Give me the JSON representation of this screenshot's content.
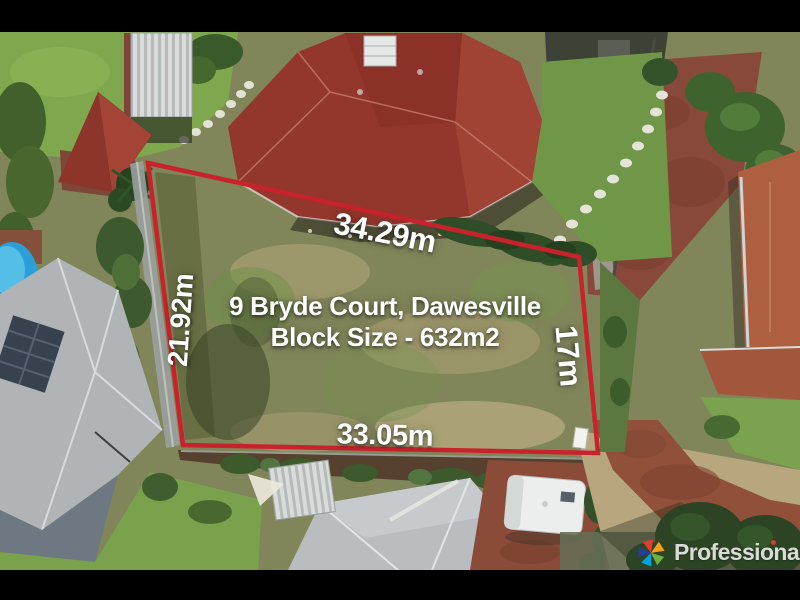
{
  "overlay": {
    "address_line1": "9 Bryde Court, Dawesville",
    "address_line2": "Block Size - 632m2",
    "dimensions": {
      "top": "34.29m",
      "left": "21.92m",
      "right": "17m",
      "bottom": "33.05m"
    }
  },
  "branding": {
    "agency_name": "Professionals",
    "logo_icon": "star-icon"
  },
  "colors": {
    "boundary_line": "#c8232c",
    "overlay_text": "#ffffff",
    "letterbox_bars": "#000000",
    "logo_text": "#e7e7e4",
    "logo_i_dot": "#e03c31",
    "logo_star": [
      "#e03c31",
      "#f6a01a",
      "#6cb33f",
      "#00a3e0",
      "#243f93"
    ]
  }
}
